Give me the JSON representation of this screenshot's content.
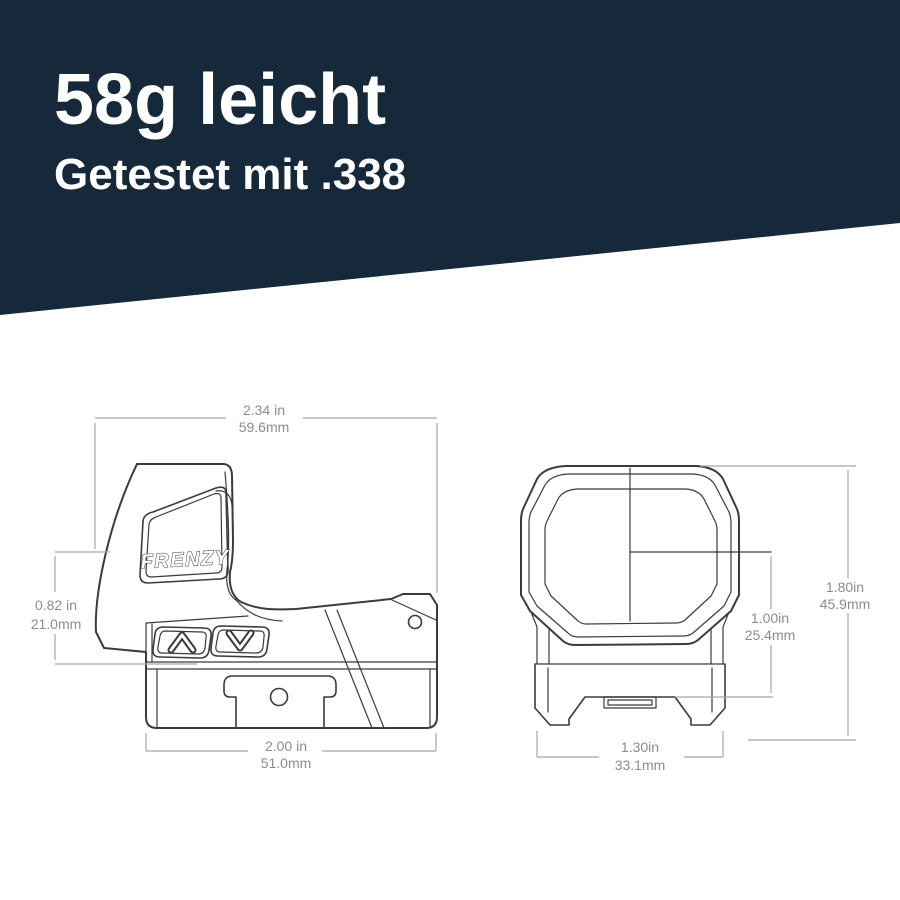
{
  "header": {
    "title": "58g leicht",
    "subtitle": "Getestet mit .338",
    "bg_color": "#15293a",
    "text_color": "#ffffff"
  },
  "drawing": {
    "brand_label": "FRENZY",
    "line_color": "#3b3b3b",
    "dim_line_color": "#a6a6a6",
    "dim_text_color": "#8c8c8c",
    "side_view": {
      "top_width": {
        "inches": "2.34 in",
        "millimeters": "59.6mm"
      },
      "front_height": {
        "inches": "0.82 in",
        "millimeters": "21.0mm"
      },
      "base_width": {
        "inches": "2.00 in",
        "millimeters": "51.0mm"
      }
    },
    "front_view": {
      "total_height": {
        "inches": "1.80in",
        "millimeters": "45.9mm"
      },
      "axis_height": {
        "inches": "1.00in",
        "millimeters": "25.4mm"
      },
      "rail_width": {
        "inches": "1.30in",
        "millimeters": "33.1mm"
      }
    },
    "buttons": [
      "up",
      "down"
    ]
  }
}
